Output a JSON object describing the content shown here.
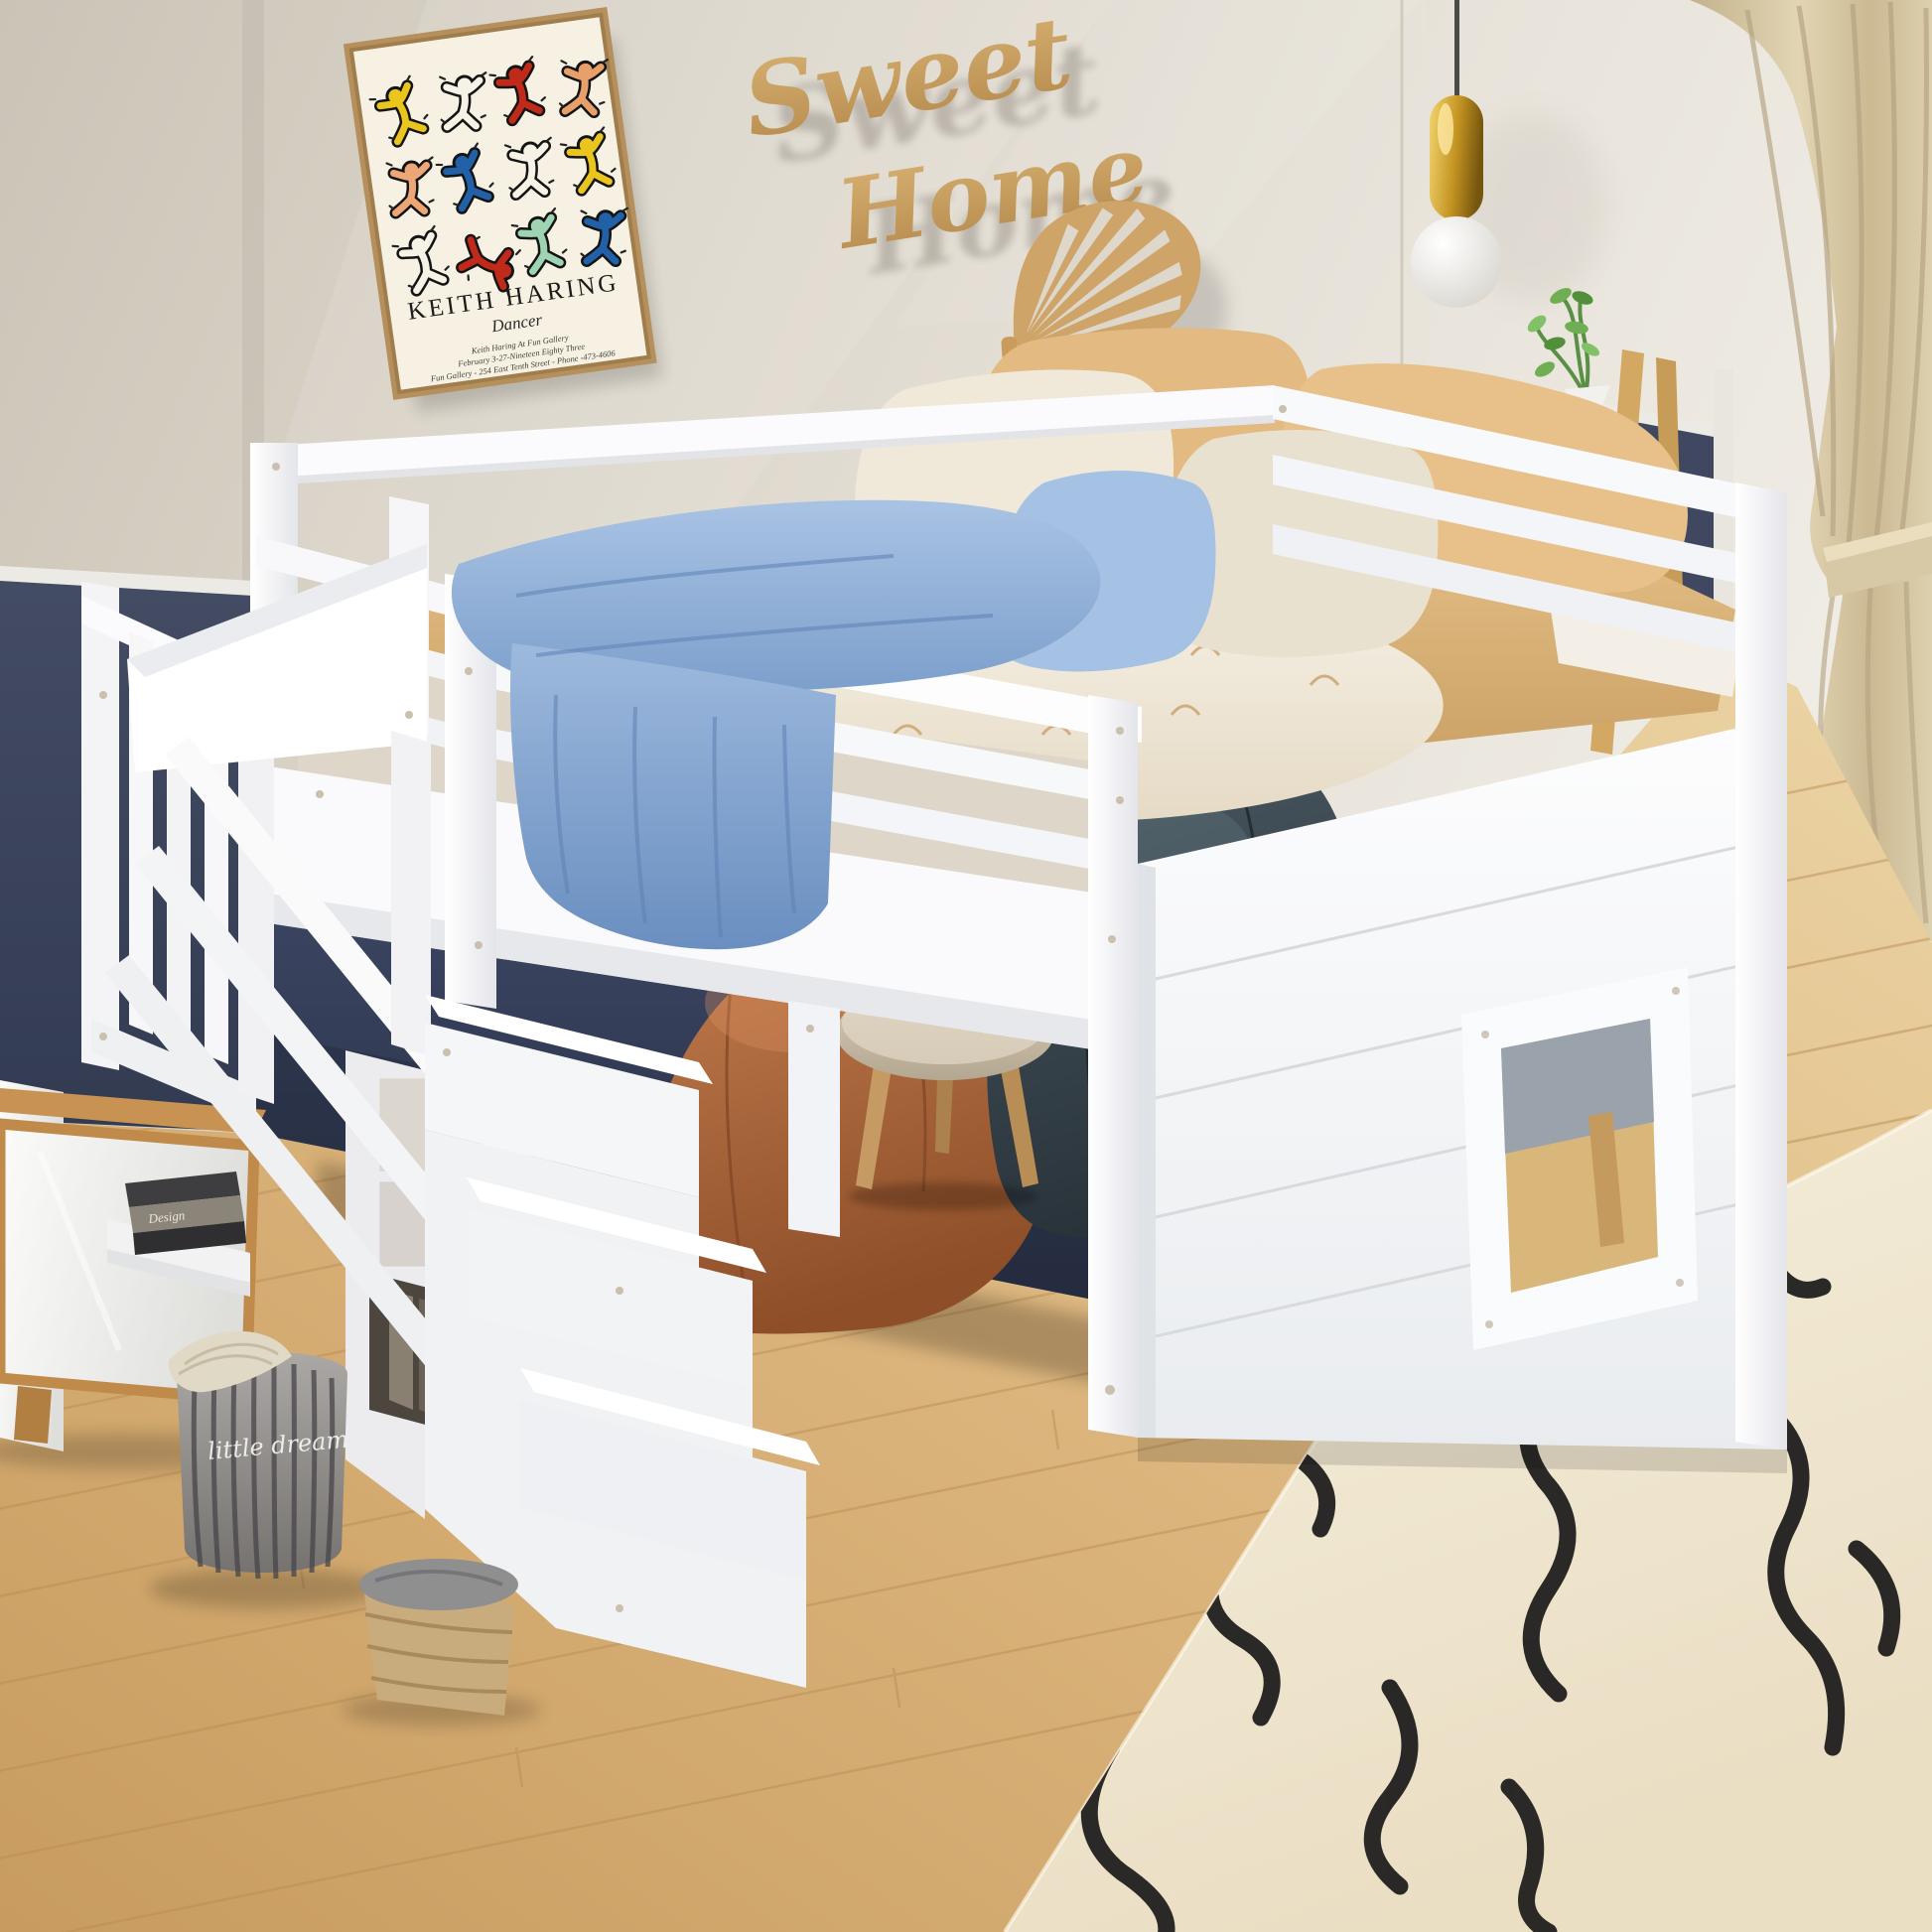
{
  "scene": {
    "type": "product photograph",
    "description": "white loft bed with storage staircase and playhouse panel in a kids bedroom"
  },
  "poster": {
    "title": "KEITH HARING",
    "subtitle": "Dancer",
    "line1": "Keith Haring At Fun Gallery",
    "line2": "February 3-27-Nineteen Eighty Three",
    "line3": "Fun Gallery - 254 East Tenth Street - Phone -473-4606",
    "background": "#f6f1e3",
    "frame_color": "#b6905c",
    "figure_colors": [
      "#e9c51d",
      "#f6f2e6",
      "#c02a1a",
      "#e8a06a",
      "#eda776",
      "#2061a8",
      "#9fd4b2"
    ]
  },
  "wall_sign": {
    "word1": "Sweet",
    "word2": "Home",
    "color": "#c69c63"
  },
  "pouf": {
    "text": "little dream"
  },
  "books": {
    "spine_text": "Design"
  },
  "palette": {
    "wall": "#ddd6ca",
    "wainscot_navy": "#3c455c",
    "floor_wood": "#d9b078",
    "rug_cream": "#f2ebd8",
    "rug_line_black": "#191919",
    "bed_white": "#fbfbfd",
    "mattress_tan": "#d8b176",
    "blanket_blue": "#8fb0d8",
    "pillow_tan": "#e2bb84",
    "pillow_cream": "#ece4d3",
    "beanbag_teal": "#3f4d55",
    "beanbag_rust": "#b06a42",
    "curtain_beige": "#d9cba9",
    "wood_accent": "#c99c5e",
    "gold_lamp": "#c59b2e"
  },
  "objects": [
    "keith-haring-poster",
    "sweet-home-sign",
    "monstera-wall-decor",
    "pendant-lamp",
    "beige-curtain",
    "wooden-ladder",
    "green-plant",
    "white-vase",
    "loft-bed",
    "guard-rails",
    "playhouse-panel-with-window",
    "storage-staircase",
    "striped-pouf",
    "woven-basket",
    "book-shelf",
    "wooden-cabinet",
    "teal-beanbag",
    "rust-beanbag",
    "round-stool",
    "cream-area-rug",
    "wood-floor"
  ]
}
